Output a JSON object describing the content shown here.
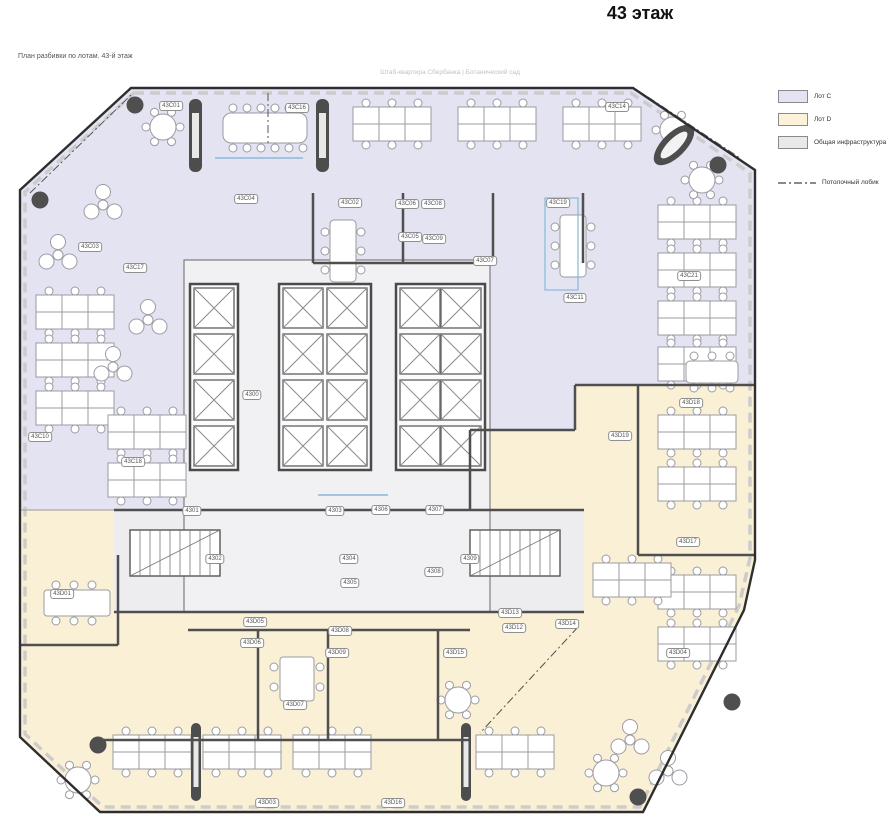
{
  "page": {
    "title": "43 этаж",
    "caption": "План разбивки по лотам. 43-й этаж",
    "watermark": "Штаб-квартира Сбербанка | Ботанический сад"
  },
  "legend": {
    "items": [
      {
        "label": "Лот C",
        "color": "#e3e3f4"
      },
      {
        "label": "Лот D",
        "color": "#fcf2d9"
      },
      {
        "label": "Общая инфраструктура",
        "color": "#e9e9e9"
      }
    ],
    "line_label": "Потолочный лобик"
  },
  "plan": {
    "zone_colors": {
      "lot_c": "#e3e3f2",
      "lot_d": "#faf0d6",
      "core": "#f1f1f4"
    },
    "room_labels": [
      {
        "t": "43C01",
        "x": 153,
        "y": 21
      },
      {
        "t": "43C16",
        "x": 279,
        "y": 23
      },
      {
        "t": "43C14",
        "x": 599,
        "y": 22
      },
      {
        "t": "43C04",
        "x": 228,
        "y": 114
      },
      {
        "t": "43C02",
        "x": 332,
        "y": 118
      },
      {
        "t": "43C06",
        "x": 389,
        "y": 119
      },
      {
        "t": "43C08",
        "x": 415,
        "y": 119
      },
      {
        "t": "43C05",
        "x": 392,
        "y": 152
      },
      {
        "t": "43C09",
        "x": 416,
        "y": 154
      },
      {
        "t": "43C07",
        "x": 467,
        "y": 176
      },
      {
        "t": "43C19",
        "x": 540,
        "y": 118
      },
      {
        "t": "43C21",
        "x": 671,
        "y": 191
      },
      {
        "t": "43C11",
        "x": 557,
        "y": 213
      },
      {
        "t": "43C03",
        "x": 72,
        "y": 162
      },
      {
        "t": "43C17",
        "x": 117,
        "y": 183
      },
      {
        "t": "43C10",
        "x": 22,
        "y": 352
      },
      {
        "t": "43C18",
        "x": 115,
        "y": 377
      },
      {
        "t": "4300",
        "x": 234,
        "y": 310
      },
      {
        "t": "4301",
        "x": 174,
        "y": 426
      },
      {
        "t": "4302",
        "x": 197,
        "y": 474
      },
      {
        "t": "4303",
        "x": 317,
        "y": 426
      },
      {
        "t": "4304",
        "x": 331,
        "y": 474
      },
      {
        "t": "4305",
        "x": 332,
        "y": 498
      },
      {
        "t": "4306",
        "x": 363,
        "y": 425
      },
      {
        "t": "4307",
        "x": 417,
        "y": 425
      },
      {
        "t": "4308",
        "x": 416,
        "y": 487
      },
      {
        "t": "4309",
        "x": 452,
        "y": 474
      },
      {
        "t": "43D18",
        "x": 673,
        "y": 318
      },
      {
        "t": "43D19",
        "x": 602,
        "y": 351
      },
      {
        "t": "43D17",
        "x": 670,
        "y": 457
      },
      {
        "t": "43D01",
        "x": 44,
        "y": 509
      },
      {
        "t": "43D05",
        "x": 237,
        "y": 537
      },
      {
        "t": "43D06",
        "x": 234,
        "y": 558
      },
      {
        "t": "43D08",
        "x": 322,
        "y": 546
      },
      {
        "t": "43D09",
        "x": 319,
        "y": 568
      },
      {
        "t": "43D07",
        "x": 277,
        "y": 620
      },
      {
        "t": "43D15",
        "x": 437,
        "y": 568
      },
      {
        "t": "43D13",
        "x": 492,
        "y": 528
      },
      {
        "t": "43D12",
        "x": 496,
        "y": 543
      },
      {
        "t": "43D14",
        "x": 549,
        "y": 539
      },
      {
        "t": "43D04",
        "x": 660,
        "y": 568
      },
      {
        "t": "43D03",
        "x": 249,
        "y": 718
      },
      {
        "t": "43D16",
        "x": 375,
        "y": 718
      }
    ]
  }
}
